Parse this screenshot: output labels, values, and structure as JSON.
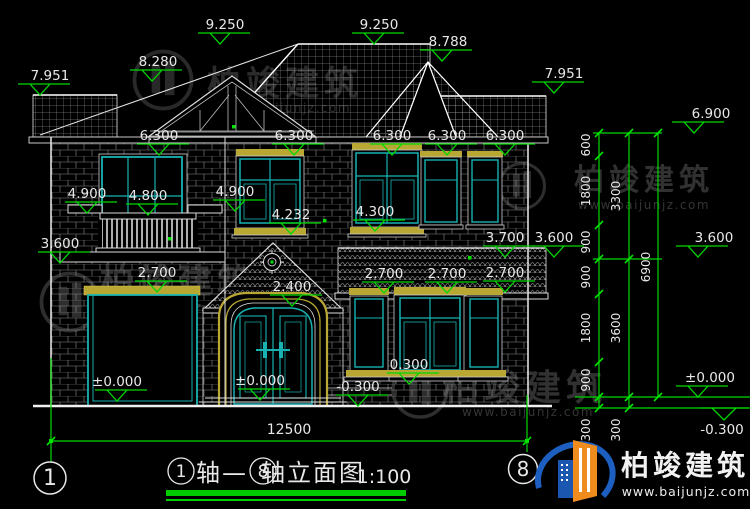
{
  "drawing": {
    "levels": {
      "v9250": "9.250",
      "v8788": "8.788",
      "v8280": "8.280",
      "v7951": "7.951",
      "v6900": "6.900",
      "v6300": "6.300",
      "v4900": "4.900",
      "v4800": "4.800",
      "v4300": "4.300",
      "v4232": "4.232",
      "v3700": "3.700",
      "v3600": "3.600",
      "v2700": "2.700",
      "v2400": "2.400",
      "v0300": "0.300",
      "vneg0300": "-0.300",
      "vzero": "±0.000"
    },
    "chain": {
      "d600": "600",
      "d900": "900",
      "d1800": "1800",
      "d300": "300",
      "d3300": "3300",
      "d3600": "3600",
      "d6900": "6900"
    },
    "overall_width": "12500",
    "axis": {
      "first": "1",
      "last": "8"
    }
  },
  "title_block": {
    "axis_prefix": "轴—",
    "name": "轴立面图",
    "scale": "1:100"
  },
  "watermark": {
    "name": "柏竣建筑",
    "url": "www.baijunjz.com"
  },
  "brand": {
    "name": "柏竣建筑",
    "url": "www.baijunjz.com"
  },
  "colors": {
    "background": "#000000",
    "line_white": "#e8e8e8",
    "window_teal": "#18b2b2",
    "trim_yellow": "#b9a733",
    "dimension_green": "#00d800",
    "title_underline_green": "#00cc00",
    "brand_blue": "#1d5fc0",
    "brand_orange": "#f08c1e"
  }
}
